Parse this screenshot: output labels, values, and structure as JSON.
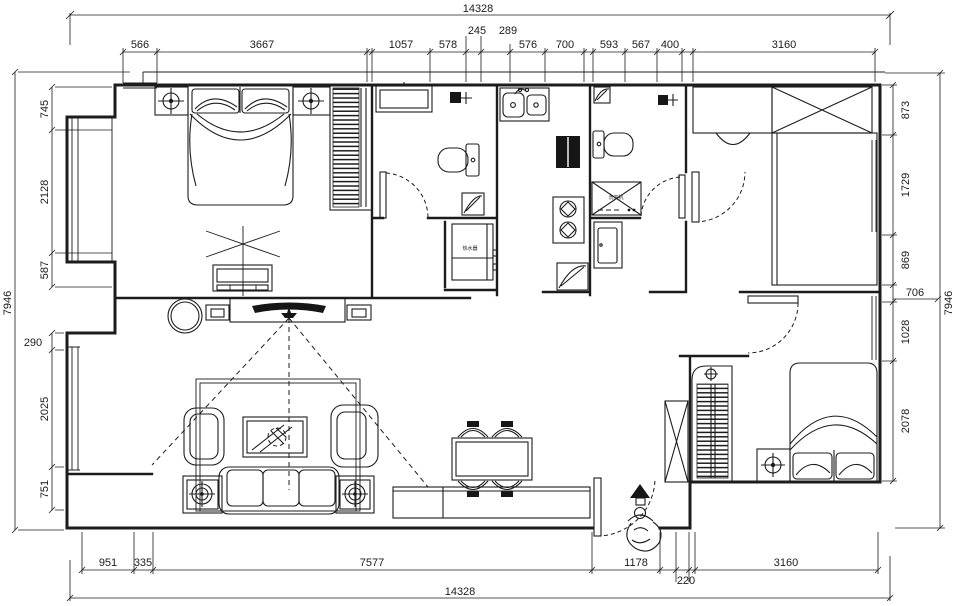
{
  "drawing": {
    "type": "residential floor plan",
    "units": "mm",
    "colors": {
      "line": "#1c1c1c",
      "bg": "#ffffff",
      "fill_dark": "#161616"
    },
    "dims": {
      "top_overall": "14328",
      "top_chain": [
        "566",
        "3667",
        "1057",
        "578",
        "245",
        "289",
        "576",
        "700",
        "593",
        "567",
        "400",
        "3160"
      ],
      "bottom_overall": "14328",
      "bottom_chain": [
        "951",
        "335",
        "7577",
        "1178",
        "220",
        "3160"
      ],
      "left_overall": "7946",
      "left_chain": [
        "745",
        "2128",
        "587",
        "290",
        "2025",
        "751"
      ],
      "right_overall": "7946",
      "right_chain": [
        "873",
        "1729",
        "869",
        "706",
        "1028",
        "2078"
      ]
    },
    "labels": {
      "washing_machine": "洗衣机",
      "water_heater": "热水器"
    }
  }
}
